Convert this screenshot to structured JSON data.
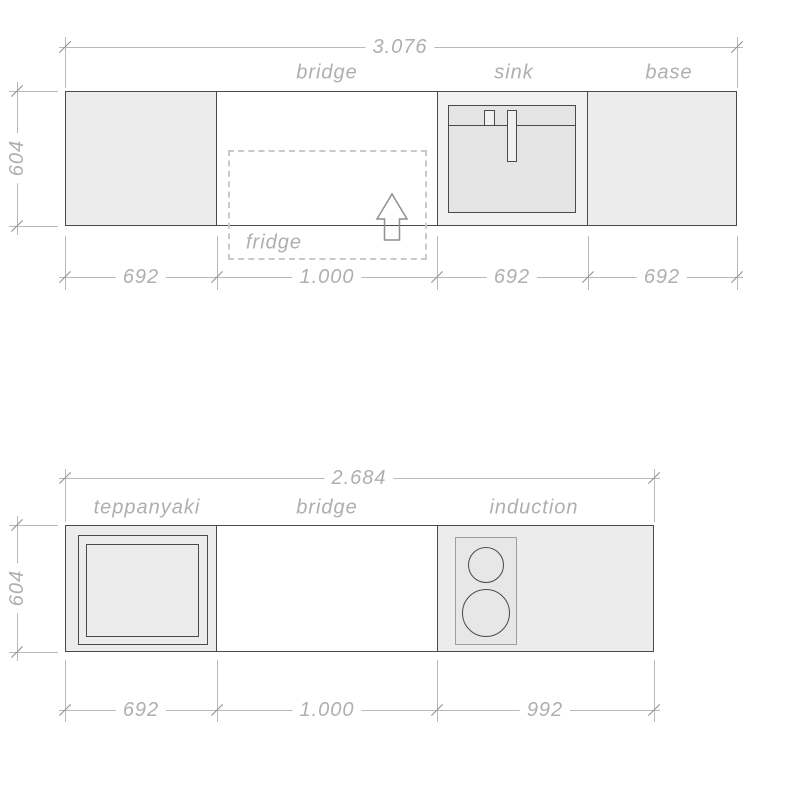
{
  "drawing_title": "kitchen worktop plan",
  "colors": {
    "background": "#ffffff",
    "block_fill": "#ececec",
    "sink_outer_fill": "#f1f1f1",
    "sink_basin_fill": "#e4e4e4",
    "hob_fill": "#e7e7e7",
    "outline": "#4a4a4a",
    "dim_line": "#b8b8b8",
    "dim_text": "#afafaf",
    "dashed_line": "#c9c9c9",
    "arrow_outline": "#8f8f8f"
  },
  "top_drawing": {
    "overall_width": "3.076",
    "height_dim": "604",
    "section_labels": [
      "bridge",
      "sink",
      "base"
    ],
    "fridge_label": "fridge",
    "segment_dims": [
      "692",
      "1.000",
      "692",
      "692"
    ]
  },
  "bottom_drawing": {
    "overall_width": "2.684",
    "height_dim": "604",
    "section_labels": [
      "teppanyaki",
      "bridge",
      "induction"
    ],
    "segment_dims": [
      "692",
      "1.000",
      "992"
    ]
  }
}
